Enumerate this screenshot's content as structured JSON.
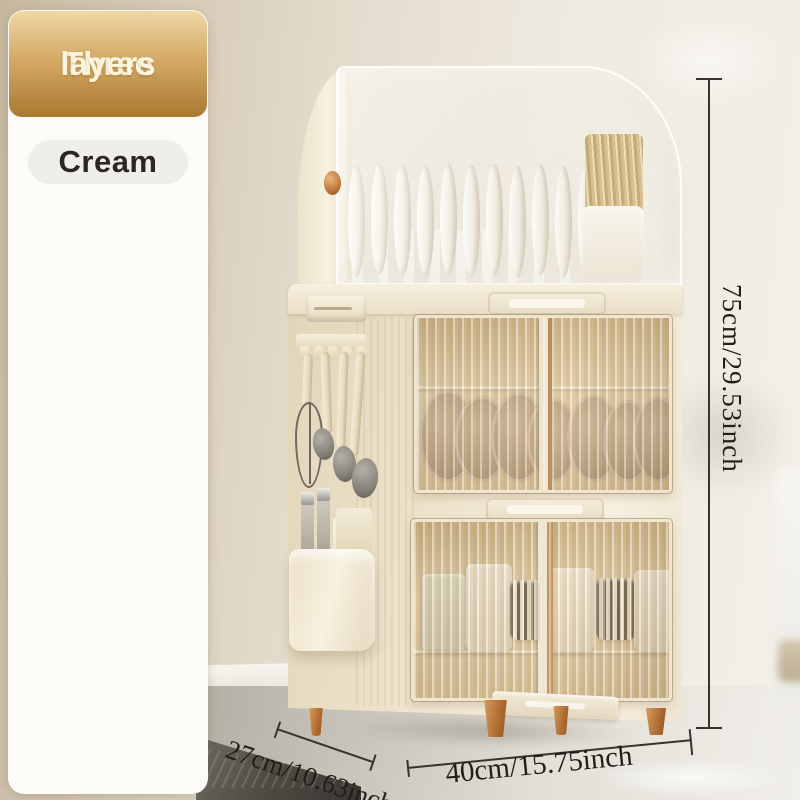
{
  "badge": {
    "line1": "Three",
    "line2": "layers"
  },
  "color_option": {
    "label": "Cream"
  },
  "feature_cards": [
    {
      "caption": "The dishes and chopsticks are sorted in an orderly manner"
    },
    {
      "caption": "Rounded edges and exquisite connectors"
    },
    {
      "caption": "Drawer-type independent drain tray"
    }
  ],
  "dimensions": {
    "height_label": "75cm/29.53inch",
    "depth_label": "27cm/10.63inch",
    "width_label": "40cm/15.75inch"
  },
  "colors": {
    "badge_gradient_top": "#eed9a6",
    "badge_gradient_bottom": "#a97930",
    "cream_body": "#eee4cd",
    "copper_accent": "#c07b3e",
    "caption_band": "#e7dcc0",
    "dimension_text": "#211d18"
  }
}
